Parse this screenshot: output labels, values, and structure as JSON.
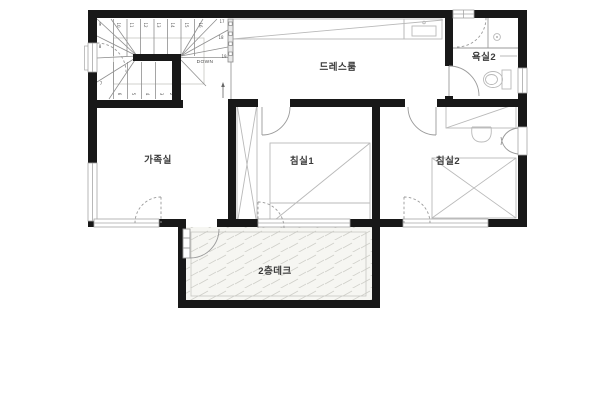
{
  "plan": {
    "type": "floor-plan",
    "floor": "2F"
  },
  "rooms": [
    {
      "id": "dress-room",
      "label": "드레스룸"
    },
    {
      "id": "bathroom-2",
      "label": "욕실2"
    },
    {
      "id": "family-room",
      "label": "가족실"
    },
    {
      "id": "bedroom-1",
      "label": "침실1"
    },
    {
      "id": "bedroom-2",
      "label": "침실2"
    },
    {
      "id": "deck-2f",
      "label": "2층데크"
    }
  ],
  "stairs": {
    "down_label": "DOWN",
    "upper_numbers": [
      "10",
      "11",
      "12",
      "13",
      "14",
      "15",
      "16"
    ],
    "right_numbers": [
      "17",
      "18",
      "19"
    ],
    "lower_numbers": [
      "6",
      "5",
      "4",
      "3",
      "2"
    ],
    "winder_numbers": [
      "7",
      "8",
      "9"
    ]
  },
  "colors": {
    "wall": "#181818",
    "line": "#9a9a9a",
    "furniture": "#b9b9b9",
    "label_text": "#3b3b3b",
    "deck_fill": "#f6f6f2",
    "deck_hatch": "#cfcfc9"
  }
}
